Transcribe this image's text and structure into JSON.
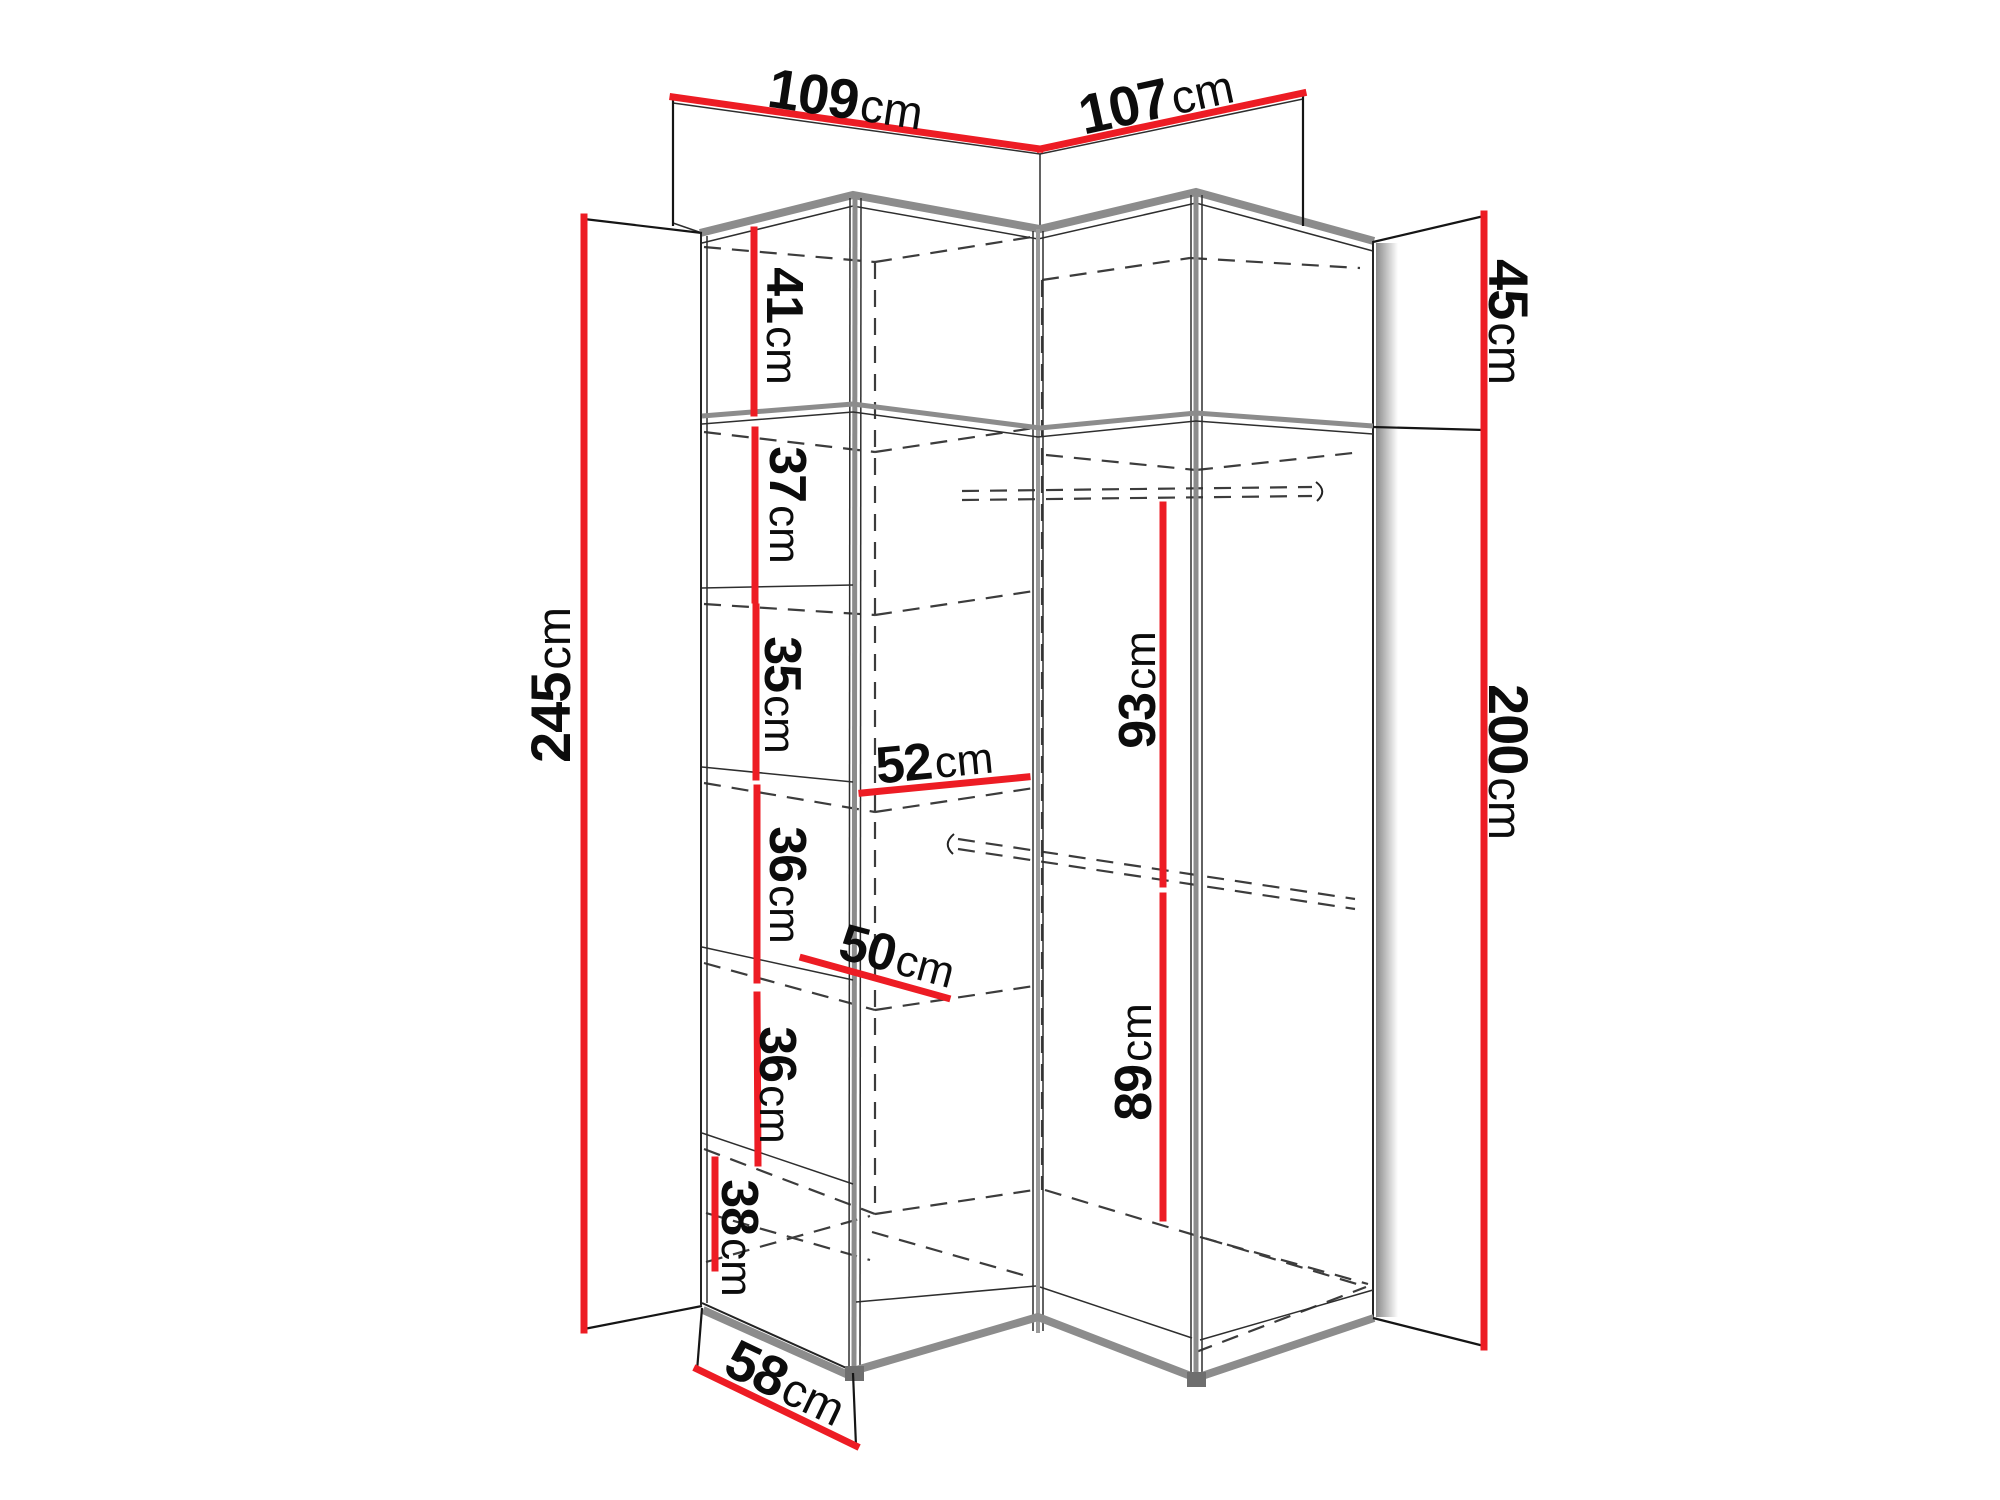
{
  "diagram": {
    "name": "corner-wardrobe-dimension-diagram",
    "colors": {
      "dimension": "#ed1c24",
      "outline": "#1a1a1a",
      "panel": "#8c8c8c",
      "dashed": "#3c3c3c",
      "background": "#ffffff"
    },
    "overall": {
      "top_width_left": {
        "value": "109",
        "unit": "cm"
      },
      "top_width_right": {
        "value": "107",
        "unit": "cm"
      },
      "total_height": {
        "value": "245",
        "unit": "cm"
      },
      "upper_section_height": {
        "value": "45",
        "unit": "cm"
      },
      "main_section_height": {
        "value": "200",
        "unit": "cm"
      },
      "depth": {
        "value": "58",
        "unit": "cm"
      }
    },
    "left_compartments": {
      "c1": {
        "value": "41",
        "unit": "cm"
      },
      "c2": {
        "value": "37",
        "unit": "cm"
      },
      "c3": {
        "value": "35",
        "unit": "cm"
      },
      "c4": {
        "value": "36",
        "unit": "cm"
      },
      "c5": {
        "value": "36",
        "unit": "cm"
      },
      "c6": {
        "value": "38",
        "unit": "cm"
      }
    },
    "shelf_widths": {
      "upper": {
        "value": "52",
        "unit": "cm"
      },
      "lower": {
        "value": "50",
        "unit": "cm"
      }
    },
    "hanging_heights": {
      "upper": {
        "value": "93",
        "unit": "cm"
      },
      "lower": {
        "value": "89",
        "unit": "cm"
      }
    }
  }
}
